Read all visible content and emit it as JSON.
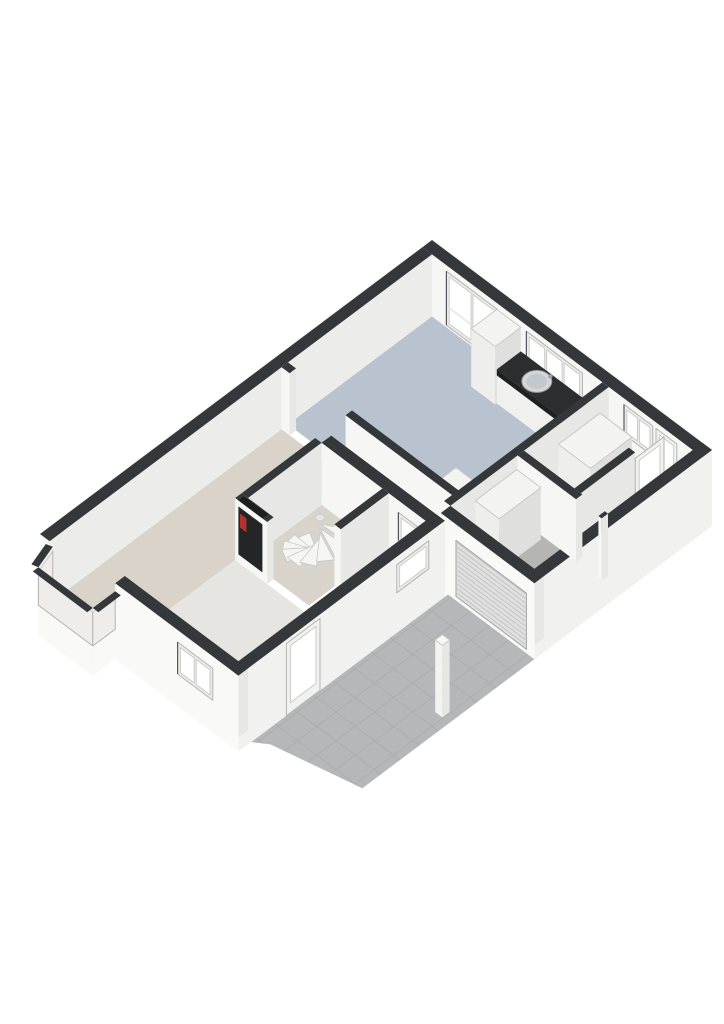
{
  "page": {
    "background": "#ffffff",
    "description": "3d-isometric-floorplan-ground-floor"
  },
  "colors": {
    "dark": "#35383a",
    "darker": "#232527",
    "nicheTop": "#1c1e20",
    "faceSW": "#f6f6f5",
    "faceSE": "#e7e7e5",
    "extSE": "#f1f1ef",
    "extSW": "#f9f9f8",
    "nwInner": "#ececea",
    "boxTop": "#f3f3f1",
    "boxSW": "#eeeeec",
    "boxSE": "#dfdfdd",
    "boxStroke": "#c9c9c7",
    "kitchen": "#b8c3cf",
    "living": "#d9d3c9",
    "hall": "#ebe9e6",
    "garage": "#b5b6b4",
    "corridor": "#e7e5e1",
    "closet": "#d8d4cb",
    "bay": "#ded8cf",
    "terrace": "#b6b7b9",
    "grout": "#a9abad",
    "glass": "#ffffff",
    "glassTint": "#efede9",
    "frame": "#ebebe9",
    "frameStroke": "#b4b4b2",
    "paneStroke": "#c7c7c6",
    "counterTop": "#2b2d2f",
    "counterEdge": "#1e2022",
    "counterSW": "#f0f0ee",
    "counterSE": "#e4e4e2",
    "sinkOuter": "#d3d7d9",
    "sinkInner": "#c2c8cb",
    "sinkStroke": "#93989b",
    "faucet": "#9aa0a3",
    "roller": "#dfe0df",
    "rollerLine": "#c3c4c3",
    "rollerStroke": "#a2a3a2",
    "stairTread": "#f5f5f4",
    "stairStroke": "#c8c8c6",
    "pole": "#e6e6e4",
    "red": "#b23430",
    "door": "#f1f1ef"
  },
  "floorplan": {
    "projection": {
      "ox": 432,
      "oy": 240,
      "ax": 0.8,
      "ay": 0.6,
      "wallTop": 62
    },
    "elements": [
      {
        "t": "floor",
        "name": "terrace-tiles",
        "fill": "terrace",
        "z": -14,
        "grid": true,
        "pts": [
          [
            242,
            222
          ],
          [
            350,
            222
          ],
          [
            350,
            437
          ],
          [
            256,
            458
          ],
          [
            242,
            468
          ]
        ]
      },
      {
        "t": "floor",
        "name": "floor-kitchen-dining",
        "fill": "kitchen",
        "pts": [
          [
            12,
            12
          ],
          [
            225,
            12
          ],
          [
            225,
            192
          ],
          [
            12,
            192
          ]
        ]
      },
      {
        "t": "floor",
        "name": "floor-hall",
        "fill": "hall",
        "pts": [
          [
            233,
            12
          ],
          [
            338,
            12
          ],
          [
            338,
            118
          ],
          [
            233,
            118
          ]
        ]
      },
      {
        "t": "floor",
        "name": "floor-garage",
        "fill": "garage",
        "pts": [
          [
            233,
            126
          ],
          [
            338,
            126
          ],
          [
            338,
            210
          ],
          [
            233,
            210
          ]
        ]
      },
      {
        "t": "floor",
        "name": "floor-living-room",
        "fill": "living",
        "pts": [
          [
            12,
            200
          ],
          [
            230,
            200
          ],
          [
            230,
            226
          ],
          [
            92,
            226
          ],
          [
            92,
            472
          ],
          [
            12,
            472
          ]
        ]
      },
      {
        "t": "floor",
        "name": "floor-hallway",
        "fill": "corridor",
        "pts": [
          [
            184,
            238
          ],
          [
            230,
            238
          ],
          [
            230,
            472
          ],
          [
            92,
            472
          ],
          [
            92,
            338
          ],
          [
            184,
            338
          ]
        ]
      },
      {
        "t": "floor",
        "name": "floor-stair-closet",
        "fill": "closet",
        "pts": [
          [
            100,
            238
          ],
          [
            176,
            238
          ],
          [
            176,
            330
          ],
          [
            100,
            330
          ]
        ]
      },
      {
        "t": "floor",
        "name": "floor-bay-window",
        "fill": "bay",
        "pts": [
          [
            12,
            484
          ],
          [
            88,
            484
          ],
          [
            88,
            512
          ],
          [
            20,
            512
          ]
        ]
      },
      {
        "t": "wall",
        "name": "wall-north-east",
        "r": [
          0,
          0,
          350,
          12
        ]
      },
      {
        "t": "window_v",
        "name": "french-doors-window",
        "v": 12,
        "u": [
          30,
          94
        ],
        "z": [
          2,
          56
        ],
        "panes": 2,
        "rail": 20
      },
      {
        "t": "window_v",
        "name": "kitchen-window",
        "v": 12,
        "u": [
          130,
          200
        ],
        "z": [
          26,
          56
        ],
        "panes": 3
      },
      {
        "t": "window_v",
        "name": "pantry-window",
        "v": 12,
        "u": [
          252,
          288
        ],
        "z": [
          26,
          56
        ],
        "panes": 2
      },
      {
        "t": "door_v",
        "name": "back-door",
        "v": 12,
        "u": [
          292,
          318
        ],
        "z": [
          2,
          56
        ]
      },
      {
        "t": "wall",
        "name": "wall-north-west",
        "r": [
          0,
          12,
          12,
          490
        ],
        "seFill": "nwInner",
        "dropSW": true
      },
      {
        "t": "box",
        "name": "kitchen-tall-cabinet",
        "r": [
          95,
          14,
          125,
          46
        ],
        "h": 58
      },
      {
        "t": "counter",
        "name": "kitchen-counter",
        "r": [
          125,
          14,
          207,
          44
        ],
        "h": 34
      },
      {
        "t": "sink",
        "name": "kitchen-sink",
        "c": [
          160,
          29
        ],
        "z": 34
      },
      {
        "t": "box",
        "name": "kitchen-island",
        "r": [
          178,
          148,
          225,
          192
        ],
        "h": 30
      },
      {
        "t": "wall",
        "name": "wall-divider-left",
        "r": [
          12,
          192,
          22,
          200
        ]
      },
      {
        "t": "wall",
        "name": "wall-divider-right",
        "r": [
          92,
          192,
          230,
          200
        ]
      },
      {
        "t": "wall",
        "name": "wall-kitchen-hall",
        "r": [
          225,
          12,
          233,
          210
        ]
      },
      {
        "t": "box",
        "name": "hall-cabinet",
        "r": [
          246,
          36,
          286,
          88
        ],
        "h": 58
      },
      {
        "t": "wall",
        "name": "wall-vestibule",
        "r": [
          296,
          50,
          304,
          118
        ]
      },
      {
        "t": "door_u",
        "name": "vestibule-door",
        "u": 304,
        "v": [
          14,
          50
        ],
        "z": [
          0,
          56
        ]
      },
      {
        "t": "wall",
        "name": "wall-south-east",
        "r": [
          338,
          0,
          350,
          222
        ],
        "dropSE": true
      },
      {
        "t": "wall",
        "name": "wall-garage-hall-left",
        "r": [
          233,
          118,
          306,
          126
        ]
      },
      {
        "t": "wall",
        "name": "wall-garage-hall-right",
        "r": [
          334,
          118,
          338,
          126
        ]
      },
      {
        "t": "box",
        "name": "garage-cabinet",
        "r": [
          236,
          130,
          266,
          182
        ],
        "h": 52
      },
      {
        "t": "wall",
        "name": "wall-garage-front",
        "r": [
          233,
          210,
          350,
          222
        ],
        "dropSW": true
      },
      {
        "t": "roller",
        "name": "garage-roller-door",
        "v": 222,
        "u": [
          252,
          340
        ],
        "z": [
          -10,
          46
        ]
      },
      {
        "t": "wall",
        "name": "wall-front-middle",
        "r": [
          100,
          226,
          242,
          238
        ]
      },
      {
        "t": "window_v",
        "name": "hallway-front-window",
        "v": 238,
        "u": [
          196,
          222
        ],
        "z": [
          22,
          50
        ],
        "panes": 1
      },
      {
        "t": "wall",
        "name": "wall-closet-left",
        "r": [
          92,
          238,
          100,
          330
        ]
      },
      {
        "t": "stairs",
        "name": "spiral-staircase",
        "c": [
          148,
          288
        ],
        "r": 34,
        "a0": 210,
        "a1": -30,
        "n": 9
      },
      {
        "t": "wall",
        "name": "wall-closet-right",
        "r": [
          176,
          238,
          184,
          298
        ]
      },
      {
        "t": "wall",
        "name": "wall-closet-bottom",
        "r": [
          92,
          330,
          132,
          338
        ]
      },
      {
        "t": "meter",
        "name": "meter-cupboard",
        "v": 338,
        "u": [
          96,
          126
        ],
        "z": [
          8,
          56
        ]
      },
      {
        "t": "wall",
        "name": "wall-living-side",
        "r": [
          230,
          226,
          242,
          484
        ],
        "dropSE": true
      },
      {
        "t": "window_u",
        "name": "side-window",
        "u": 242,
        "v": [
          246,
          286
        ],
        "z": [
          26,
          54
        ],
        "panes": 1
      },
      {
        "t": "door_u",
        "name": "side-entrance-door",
        "u": 242,
        "v": [
          382,
          424
        ],
        "z": [
          -14,
          58
        ]
      },
      {
        "t": "wall",
        "name": "wall-front-living",
        "r": [
          88,
          472,
          242,
          484
        ],
        "dropSW": true
      },
      {
        "t": "window_v",
        "name": "front-window",
        "v": 484,
        "u": [
          166,
          210
        ],
        "z": [
          18,
          50
        ],
        "panes": 2
      },
      {
        "t": "strip",
        "name": "bay-window-left",
        "p1": [
          12,
          486
        ],
        "p2": [
          20,
          512
        ],
        "nrm": [
          -0.96,
          0.29
        ]
      },
      {
        "t": "strip",
        "name": "bay-window-front",
        "p1": [
          20,
          512
        ],
        "p2": [
          88,
          512
        ],
        "nrm": [
          0,
          1
        ]
      },
      {
        "t": "strip",
        "name": "bay-window-right",
        "p1": [
          88,
          512
        ],
        "p2": [
          88,
          484
        ],
        "nrm": [
          1,
          0
        ]
      },
      {
        "t": "box",
        "name": "driveway-post",
        "r": [
          332,
          319,
          341,
          328
        ],
        "h": 58,
        "z0": -14,
        "bright": true
      }
    ]
  }
}
